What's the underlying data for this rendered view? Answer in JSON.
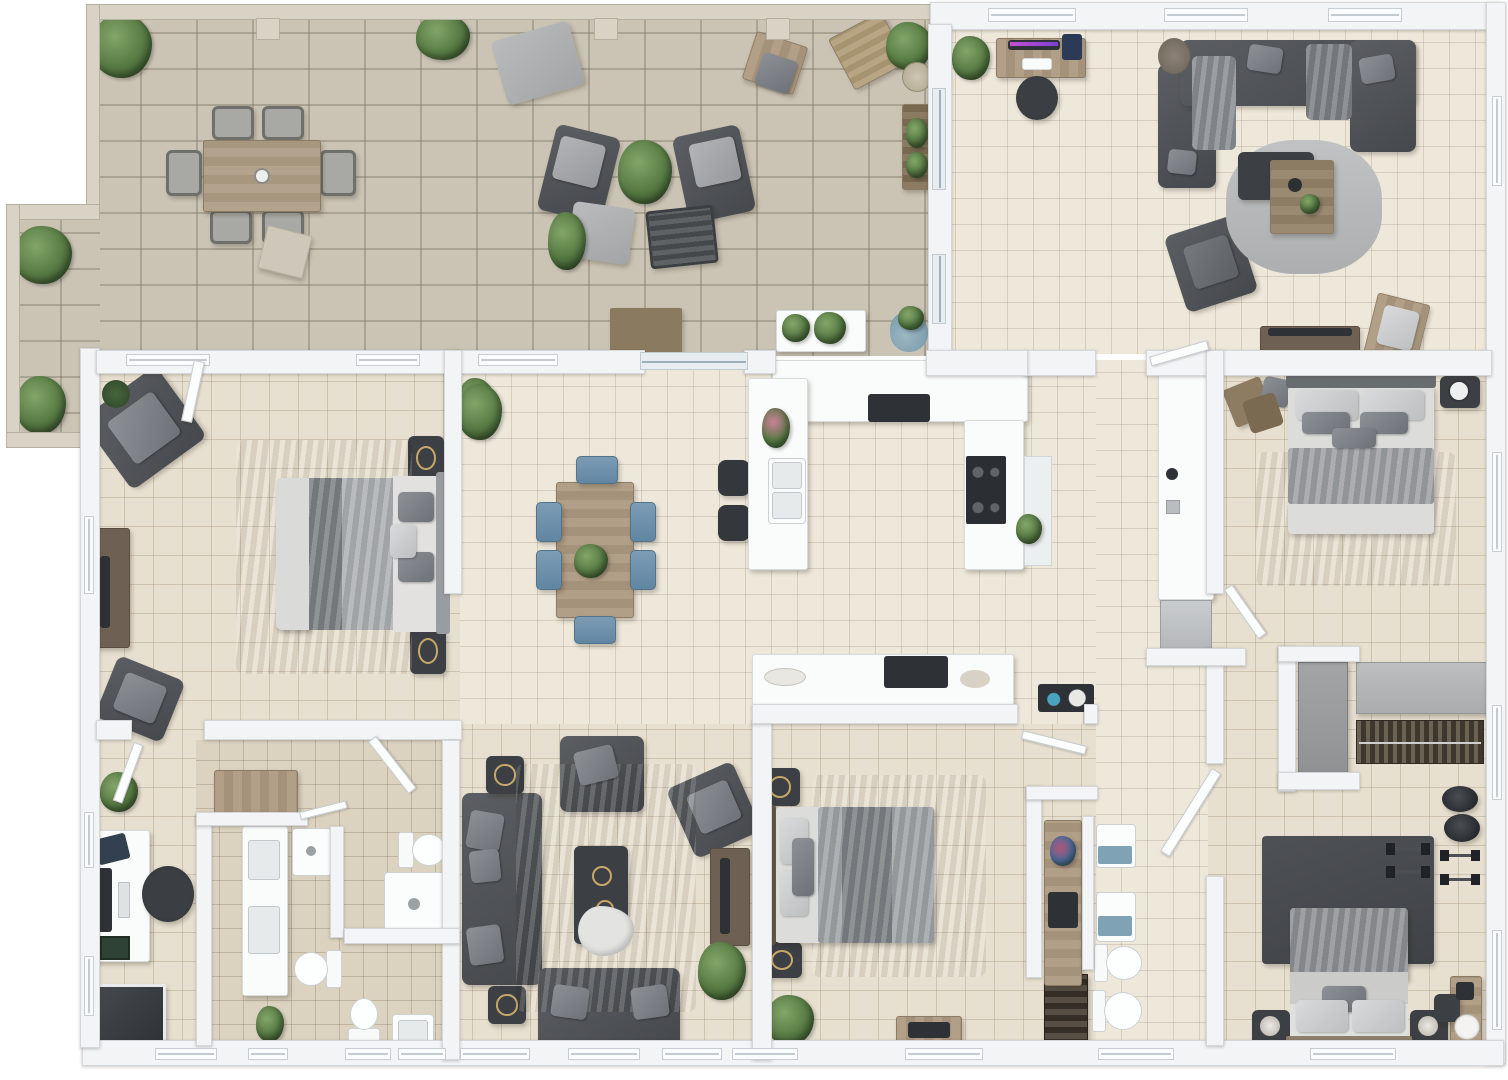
{
  "meta": {
    "kind": "3D rendered apartment floor plan, top-down view",
    "text_visible": "none"
  },
  "palette": {
    "outside": "#ffffff",
    "patio_stone": "#cbc4b5",
    "floor_tile": "#e7dfcf",
    "floor_tile_light": "#eee8db",
    "floor_tile_bath": "#dbd2bf",
    "wall": "#f3f4f6",
    "sofa_dark": "#54575b",
    "wood": "#a89680",
    "rug_dark": "#77797b",
    "rug_light": "#b6b8ba",
    "chair_blue": "#7193ad",
    "plant_green": "#567a43",
    "appliance_dark": "#2e3135",
    "accent_purple": "#b44bd0",
    "accent_blue": "#6fa4bd"
  },
  "rooms": [
    {
      "id": "patio",
      "label": "Patio terrace",
      "furniture": [
        "outdoor dining table",
        "6 outdoor chairs",
        "chaise lounge",
        "sun lounger",
        "2 lounge armchairs",
        "ottoman",
        "slatted coffee table",
        "planter bench",
        "side tables",
        "doormat",
        "plant bench",
        "8 plants"
      ]
    },
    {
      "id": "living-top",
      "label": "Living room (top right)",
      "furniture": [
        "computer desk with monitor",
        "office chair",
        "U-shaped sectional sofa",
        "round rug",
        "coffee table",
        "side table",
        "armchair",
        "TV console with TV",
        "accent chair",
        "plants"
      ]
    },
    {
      "id": "bedroom-master",
      "label": "Master bedroom (left)",
      "furniture": [
        "double bed",
        "2 nightstands",
        "dark rug",
        "loveseat",
        "armchair",
        "TV sideboard",
        "plant"
      ]
    },
    {
      "id": "dining",
      "label": "Dining area",
      "furniture": [
        "dining table",
        "6 blue chairs",
        "centerpiece plant"
      ]
    },
    {
      "id": "kitchen",
      "label": "Kitchen",
      "furniture": [
        "U-shaped counter",
        "double sink",
        "cooktop",
        "wall cabinets",
        "2 bar stools",
        "flowers"
      ]
    },
    {
      "id": "bedroom-right",
      "label": "Bedroom (right middle)",
      "furniture": [
        "double bed",
        "nightstand with fan",
        "bench with bags",
        "rug"
      ]
    },
    {
      "id": "hallway",
      "label": "Hallway / utility",
      "furniture": [
        "tall cabinet",
        "appliance"
      ]
    },
    {
      "id": "office",
      "label": "Home office (bottom left)",
      "furniture": [
        "desk with monitor",
        "office chair",
        "dark glass shower",
        "wood console",
        "plant"
      ]
    },
    {
      "id": "bathrooms",
      "label": "Bathrooms (center left)",
      "furniture": [
        "double vanity",
        "wood cabinet",
        "2 showers",
        "3 toilets",
        "sink",
        "plant basket"
      ]
    },
    {
      "id": "living-lower",
      "label": "Living room (bottom center)",
      "furniture": [
        "3-seat sofa",
        "loveseat",
        "2 armchairs",
        "coffee table with throw",
        "2 side tables",
        "TV stand with TV",
        "rug",
        "plant"
      ]
    },
    {
      "id": "bedroom-lower",
      "label": "Bedroom (bottom center)",
      "furniture": [
        "double bed",
        "2 nightstands",
        "rug",
        "TV bench",
        "plant",
        "console with decor"
      ]
    },
    {
      "id": "ensuite",
      "label": "Ensuite / WC (bottom center-right)",
      "furniture": [
        "wood vanity shelf",
        "2 sinks",
        "2 toilets",
        "shoe rack",
        "flowers"
      ]
    },
    {
      "id": "bedroom-corner",
      "label": "Bedroom (bottom right)",
      "furniture": [
        "double bed",
        "2 nightstands with lamps",
        "exercise mat",
        "2 dumbbell pairs",
        "2 poufs",
        "desk with chair",
        "wardrobe",
        "clothes rail",
        "gray cabinet"
      ]
    },
    {
      "id": "closet",
      "label": "Closet niche",
      "furniture": [
        "gray wardrobe",
        "hanging clothes rail",
        "cabinet strip"
      ]
    }
  ]
}
